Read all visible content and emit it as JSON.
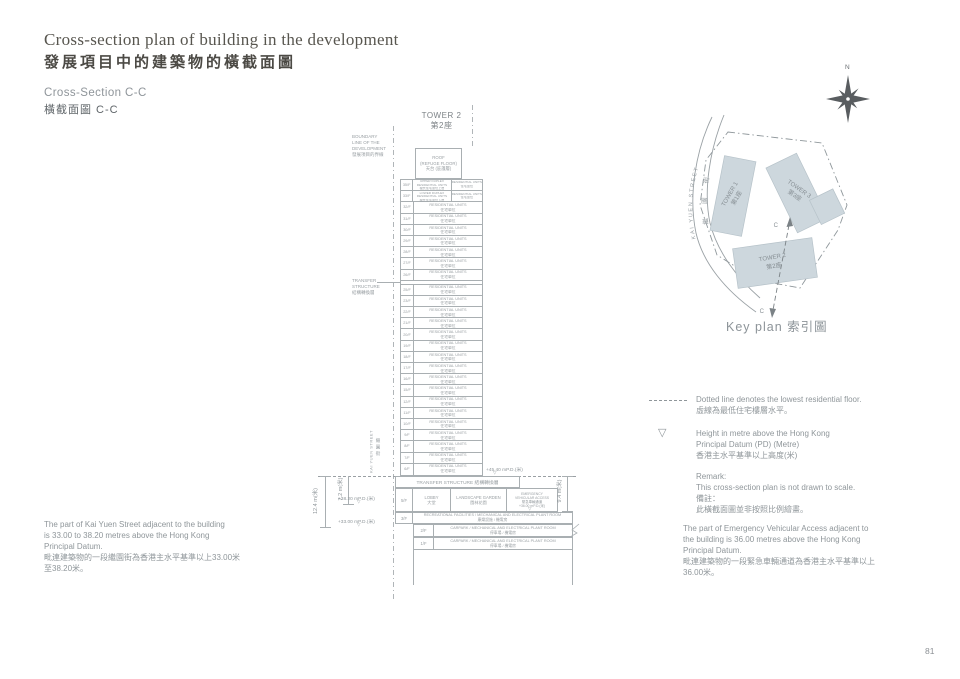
{
  "header": {
    "title_en": "Cross-section plan of building in the development",
    "title_zh": "發展項目中的建築物的橫截面圖",
    "section_en": "Cross-Section C-C",
    "section_zh": "橫截面圖 C-C"
  },
  "section": {
    "tower_title_en": "TOWER 2",
    "tower_title_zh": "第2座",
    "boundary_label": {
      "l1": "BOUNDARY",
      "l2": "LINE OF THE",
      "l3": "DEVELOPMENT",
      "l4": "發展項目的界線"
    },
    "roof": {
      "l1": "ROOF",
      "l2": "(REFUGE FLOOR)",
      "l3": "天台 (庇護層)"
    },
    "labels": {
      "residential_en": "RESIDENTIAL UNITS",
      "residential_zh": "住宅單位",
      "duplex_upper_1": "UPPER DUPLEX",
      "duplex_upper_2": "RESIDENTIAL UNITS",
      "duplex_upper_zh": "複式住宅單位上層",
      "duplex_lower_1": "LOWER DUPLEX",
      "duplex_lower_2": "RESIDENTIAL UNITS",
      "duplex_lower_zh": "複式住宅單位下層"
    },
    "floors": [
      {
        "label": "35/F",
        "type": "duplex-upper"
      },
      {
        "label": "33/F",
        "type": "duplex-lower"
      },
      {
        "label": "32/F",
        "type": "res"
      },
      {
        "label": "31/F",
        "type": "res"
      },
      {
        "label": "30/F",
        "type": "res"
      },
      {
        "label": "29/F",
        "type": "res"
      },
      {
        "label": "28/F",
        "type": "res"
      },
      {
        "label": "27/F",
        "type": "res"
      },
      {
        "label": "26/F",
        "type": "res"
      },
      {
        "label": "",
        "type": "transfer"
      },
      {
        "label": "25/F",
        "type": "res"
      },
      {
        "label": "23/F",
        "type": "res"
      },
      {
        "label": "22/F",
        "type": "res"
      },
      {
        "label": "21/F",
        "type": "res"
      },
      {
        "label": "20/F",
        "type": "res"
      },
      {
        "label": "19/F",
        "type": "res"
      },
      {
        "label": "18/F",
        "type": "res"
      },
      {
        "label": "17/F",
        "type": "res"
      },
      {
        "label": "16/F",
        "type": "res"
      },
      {
        "label": "15/F",
        "type": "res"
      },
      {
        "label": "12/F",
        "type": "res"
      },
      {
        "label": "11/F",
        "type": "res"
      },
      {
        "label": "10/F",
        "type": "res"
      },
      {
        "label": "9/F",
        "type": "res"
      },
      {
        "label": "8/F",
        "type": "res"
      },
      {
        "label": "7/F",
        "type": "res"
      },
      {
        "label": "6/F",
        "type": "res"
      }
    ],
    "transfer_side": {
      "l1": "TRANSFER",
      "l2": "STRUCTURE",
      "l3": "結構轉換層"
    },
    "transfer_band": "TRANSFER STRUCTURE 結構轉換層",
    "podium": {
      "f5": {
        "label": "5/F",
        "lobby_en": "LOBBY",
        "lobby_zh": "大堂",
        "garden_en": "LANDSCAPE GARDEN",
        "garden_zh": "園林花園",
        "eva_1": "EMERGENCY",
        "eva_2": "VEHICULAR ACCESS",
        "eva_zh": "緊急車輛通道",
        "eva_level": "+36.00 mP.D.(米)"
      },
      "f3": {
        "label": "3/F",
        "en": "RECREATIONAL FACILITIES / MECHANICAL AND ELECTRICAL PLANT ROOM",
        "zh": "康樂設施 / 機電房"
      },
      "f2": {
        "label": "2/F",
        "en": "CARPARK / MECHANICAL AND ELECTRICAL PLANT ROOM",
        "zh": "停車場 / 機電房"
      },
      "f1": {
        "label": "1/F",
        "en": "CARPARK / MECHANICAL AND ELECTRICAL PLANT ROOM",
        "zh": "停車場 / 機電房"
      }
    },
    "levels": {
      "lowest_res": "+45.40 mP.D.(米)",
      "street_high": "+38.20 mP.D.(米)",
      "street_low": "+33.00 mP.D.(米)"
    },
    "dims": {
      "d_12_4": "12.4 m(米)",
      "d_7_2": "7.2 m(米)",
      "d_9_4": "9.4 m(米)"
    },
    "street": {
      "en": "KAI YUEN STREET",
      "zh": "繼園街"
    }
  },
  "keyplan": {
    "north": "N",
    "street_en": "KAI YUEN STREET",
    "street_zh": "繼 園 街",
    "towers": [
      {
        "en": "TOWER 1",
        "zh": "第1座"
      },
      {
        "en": "TOWER 3",
        "zh": "第3座"
      },
      {
        "en": "TOWER 2",
        "zh": "第2座"
      }
    ],
    "section_marker": "C",
    "caption": "Key plan 索引圖"
  },
  "legend": {
    "dotted_en": "Dotted line denotes the lowest residential floor.",
    "dotted_zh": "虛線為最低住宅樓層水平。",
    "height_en1": "Height in metre above the Hong Kong",
    "height_en2": "Principal Datum (PD) (Metre)",
    "height_zh": "香港主水平基準以上高度(米)",
    "remark_title": "Remark:",
    "remark_en": "This cross-section plan is not drawn to scale.",
    "remark_zh_title": "備註：",
    "remark_zh": "此橫截面圖並非按照比例繪畫。"
  },
  "notes": {
    "left": {
      "en1": "The part of Kai Yuen Street adjacent to the building",
      "en2": "is 33.00 to 38.20 metres above the Hong Kong",
      "en3": "Principal Datum.",
      "zh1": "毗連建築物的一段繼園街為香港主水平基準以上33.00米",
      "zh2": "至38.20米。"
    },
    "right": {
      "en1": "The part of Emergency Vehicular Access adjacent to",
      "en2": "the building is 36.00 metres above the Hong Kong",
      "en3": "Principal Datum.",
      "zh1": "毗連建築物的一段緊急車輛通道為香港主水平基準以上",
      "zh2": "36.00米。"
    }
  },
  "page_number": "81"
}
